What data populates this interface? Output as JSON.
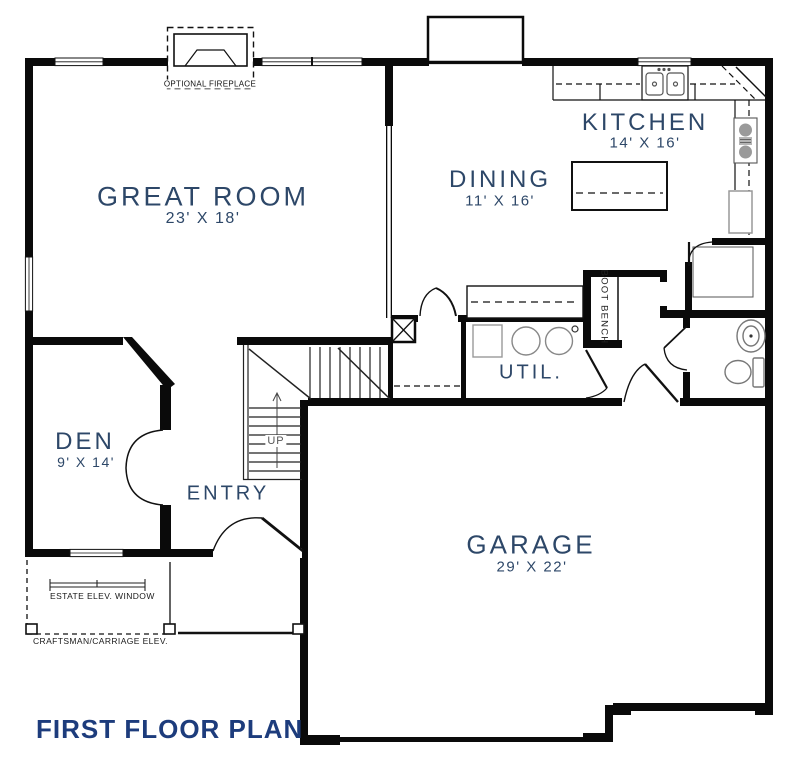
{
  "title": "FIRST FLOOR PLAN",
  "rooms": {
    "great_room": {
      "name": "GREAT ROOM",
      "dims": "23' X 18'"
    },
    "kitchen": {
      "name": "KITCHEN",
      "dims": "14' X 16'"
    },
    "dining": {
      "name": "DINING",
      "dims": "11' X 16'"
    },
    "den": {
      "name": "DEN",
      "dims": "9' X 14'"
    },
    "garage": {
      "name": "GARAGE",
      "dims": "29' X 22'"
    },
    "entry": {
      "name": "ENTRY"
    },
    "util": {
      "name": "UTIL."
    }
  },
  "annotations": {
    "optional_fireplace": "OPTIONAL FIREPLACE",
    "boot_bench": "BOOT BENCH",
    "stair_direction": "UP",
    "estate_window": "ESTATE ELEV. WINDOW",
    "craftsman_elev": "CRAFTSMAN/CARRIAGE ELEV."
  },
  "colors": {
    "wall": "#0a0a0a",
    "room_label": "#2d4768",
    "title": "#1d3c7c",
    "fixture": "#888888"
  }
}
